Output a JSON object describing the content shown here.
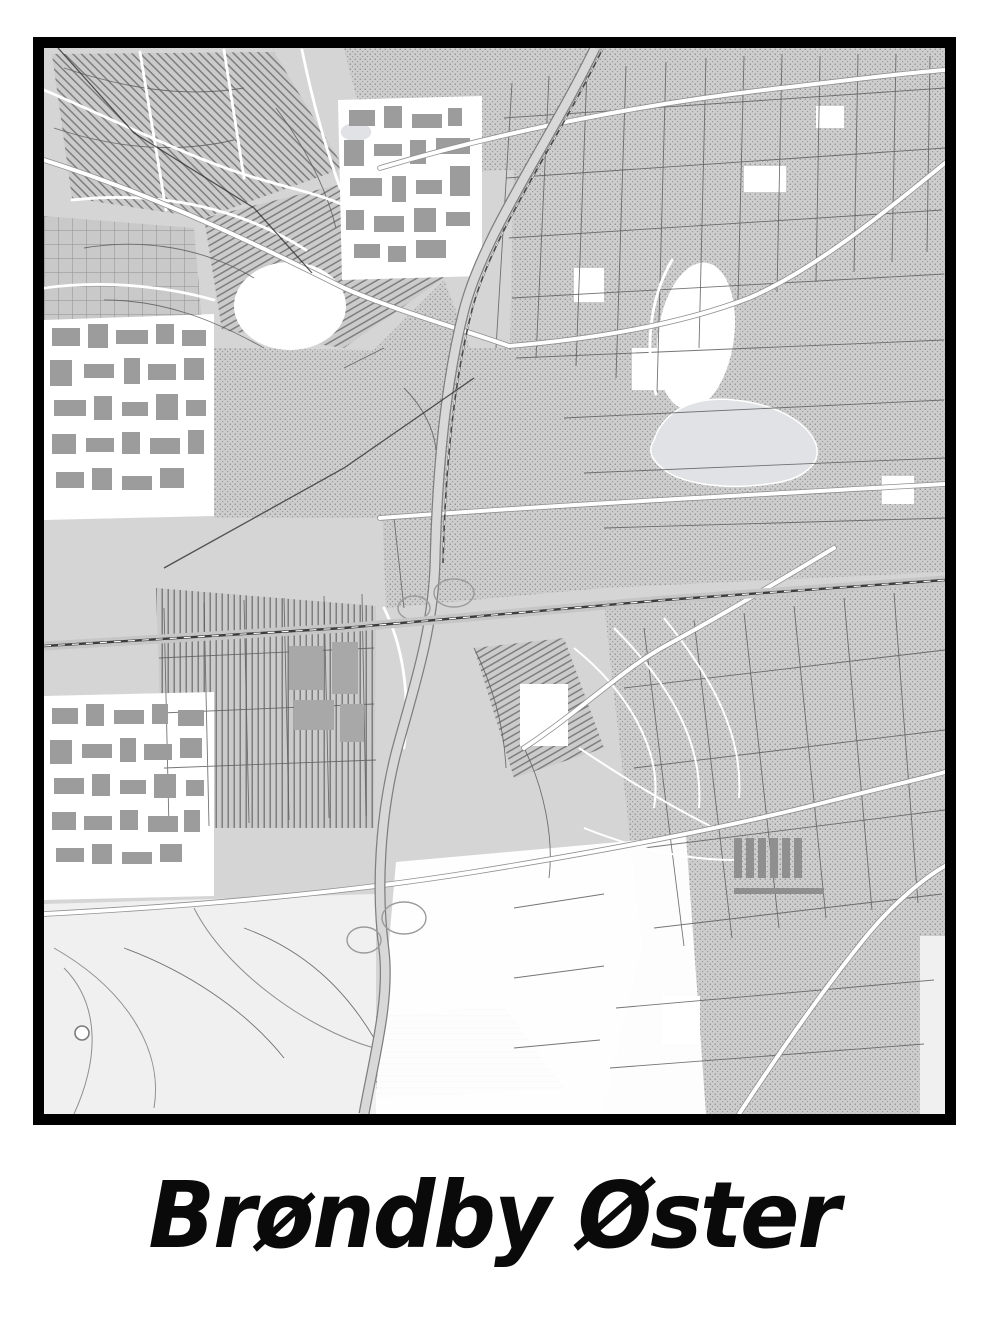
{
  "poster": {
    "title": "Brøndby Øster",
    "map": {
      "type": "monochrome-street-map",
      "labels": [],
      "colors": {
        "background": "#ffffff",
        "frame": "#000000",
        "land": "#d5d5d5",
        "open_area": "#ffffff",
        "buildings": "#9c9c9c",
        "road_major": "#ffffff",
        "road_casing": "#909090",
        "street": "#5d5d5d",
        "railway": "#3d3d3d",
        "water": "#e1e2e5",
        "title": "#0a0a0a"
      }
    }
  }
}
